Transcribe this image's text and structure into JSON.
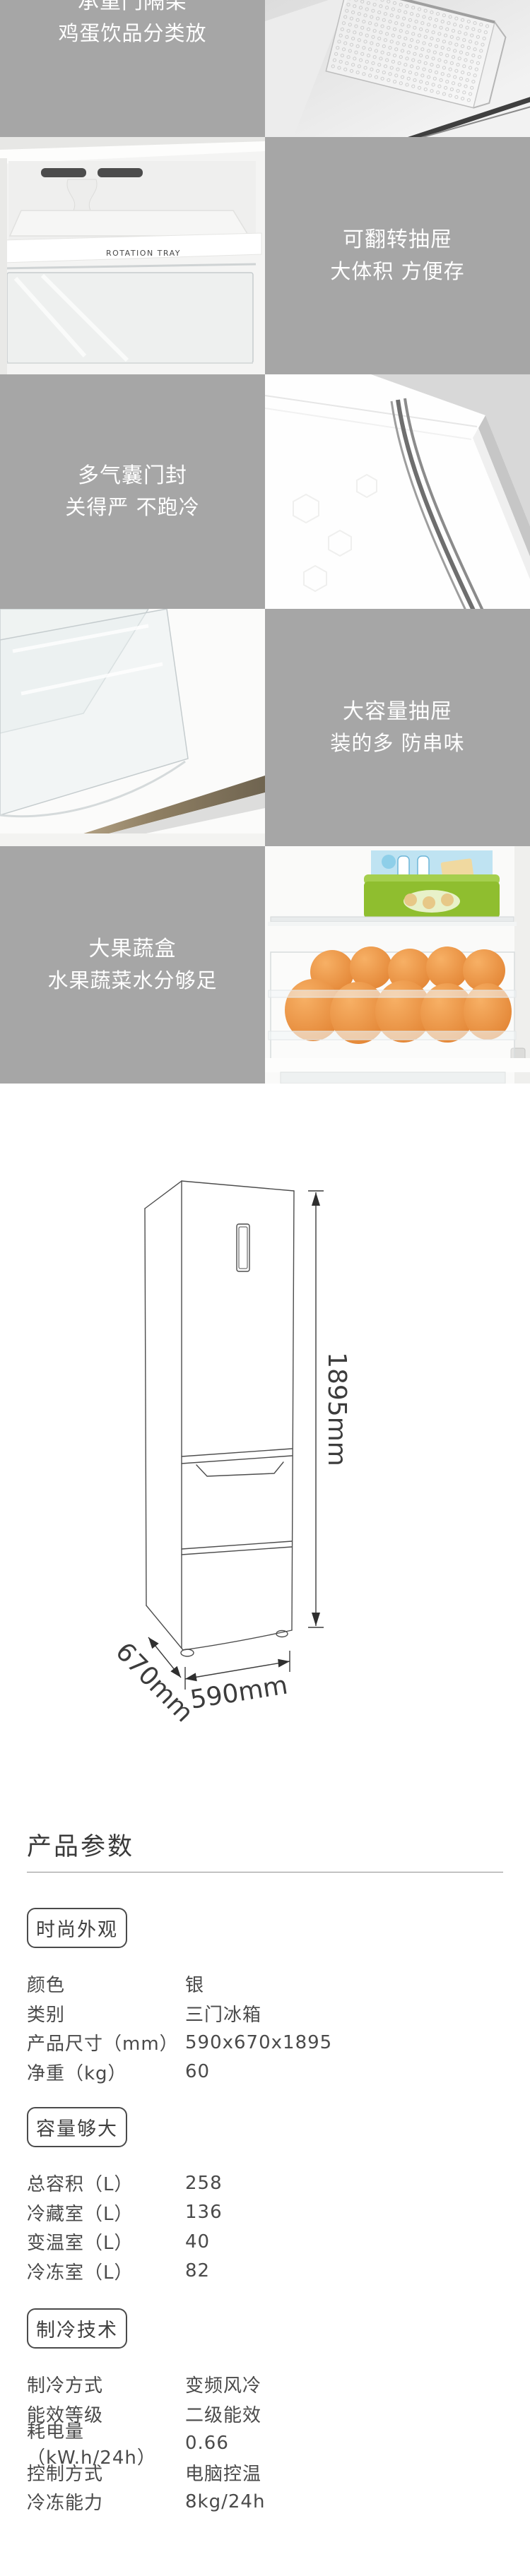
{
  "feature_blocks": [
    {
      "title": "承重门隔架",
      "subtitle": "鸡蛋饮品分类放",
      "panel_side": "left",
      "photo": "door-basket-photo"
    },
    {
      "title": "可翻转抽屉",
      "subtitle": "大体积 方便存",
      "panel_side": "right",
      "photo": "rotation-tray-photo",
      "photo_label": "ROTATION TRAY"
    },
    {
      "title": "多气囊门封",
      "subtitle": "关得严 不跑冷",
      "panel_side": "left",
      "photo": "door-seal-photo"
    },
    {
      "title": "大容量抽屉",
      "subtitle": "装的多 防串味",
      "panel_side": "right",
      "photo": "big-drawer-photo"
    },
    {
      "title": "大果蔬盒",
      "subtitle": "水果蔬菜水分够足",
      "panel_side": "left",
      "photo": "fruit-box-photo"
    }
  ],
  "diagram": {
    "height_label": "1895mm",
    "depth_label": "670mm",
    "width_label": "590mm"
  },
  "specs": {
    "heading": "产品参数",
    "sections": [
      {
        "badge": "时尚外观",
        "rows": [
          [
            "颜色",
            "银"
          ],
          [
            "类别",
            "三门冰箱"
          ],
          [
            "产品尺寸（mm）",
            "590x670x1895"
          ],
          [
            "净重（kg）",
            "60"
          ]
        ]
      },
      {
        "badge": "容量够大",
        "rows": [
          [
            "总容积（L）",
            "258"
          ],
          [
            "冷藏室（L）",
            "136"
          ],
          [
            "变温室（L）",
            "40"
          ],
          [
            "冷冻室（L）",
            "82"
          ]
        ]
      },
      {
        "badge": "制冷技术",
        "rows": [
          [
            "制冷方式",
            "变频风冷"
          ],
          [
            "能效等级",
            "二级能效"
          ],
          [
            "耗电量（kW.h/24h）",
            "0.66"
          ],
          [
            "控制方式",
            "电脑控温"
          ],
          [
            "冷冻能力",
            "8kg/24h"
          ]
        ]
      }
    ]
  },
  "colors": {
    "panel_gray": "#a6a6a6",
    "panel_text": "#ffffff",
    "spec_text": "#4a4a4a",
    "rule_gray": "#8f8f8f",
    "orange": "#ef9640",
    "green_box": "#8fbe2f",
    "blue_box": "#bfe3f2",
    "diagram_stroke": "#4d4d4d"
  }
}
